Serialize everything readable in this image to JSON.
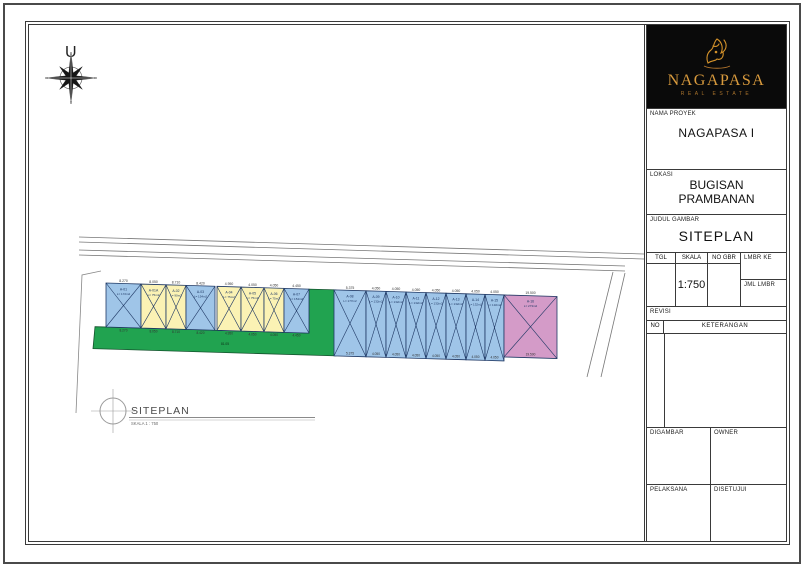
{
  "sheet": {
    "north_label": "U"
  },
  "plan": {
    "title": "SITEPLAN",
    "scale_note": "SKALA 1 : 750",
    "green_dim": "81.05",
    "colors": {
      "blue": "#9fc5e8",
      "yellow": "#fbf2b4",
      "green": "#21a350",
      "pink": "#d49bc8",
      "stroke": "#1f3864",
      "road": "#777777"
    },
    "lots": [
      {
        "id": "A-01",
        "area": "L= 172m2",
        "dim": "8.270",
        "color": "blue",
        "x": 77,
        "w": 35,
        "group": "front"
      },
      {
        "id": "A-01A",
        "area": "L= 75m2",
        "dim": "8.050",
        "color": "yellow",
        "x": 112,
        "w": 25,
        "group": "front"
      },
      {
        "id": "A-02",
        "area": "L= 90m2",
        "dim": "8.710",
        "color": "yellow",
        "x": 137,
        "w": 20,
        "group": "front"
      },
      {
        "id": "A-03",
        "area": "L= 154m2",
        "dim": "8.420",
        "color": "blue",
        "x": 157,
        "w": 29,
        "group": "front"
      },
      {
        "id": "A-04",
        "area": "L= 75m2",
        "dim": "4.950",
        "color": "yellow",
        "x": 188,
        "w": 24,
        "group": "front"
      },
      {
        "id": "A-05",
        "area": "L= 75m2",
        "dim": "4.050",
        "color": "yellow",
        "x": 212,
        "w": 23,
        "group": "front"
      },
      {
        "id": "A-06",
        "area": "L= 75m2",
        "dim": "4.050",
        "color": "yellow",
        "x": 235,
        "w": 20,
        "group": "front"
      },
      {
        "id": "A-07",
        "area": "L= 154m2",
        "dim": "4.450",
        "color": "blue",
        "x": 255,
        "w": 25,
        "group": "front"
      },
      {
        "id": "A-08",
        "area": "L= 177m2",
        "dim": "5.375",
        "color": "blue",
        "x": 305,
        "w": 32,
        "group": "back"
      },
      {
        "id": "A-09",
        "area": "L= 132m2",
        "dim": "4.050",
        "color": "blue",
        "x": 337,
        "w": 20,
        "group": "back"
      },
      {
        "id": "A-10",
        "area": "L= 132m2",
        "dim": "4.050",
        "color": "blue",
        "x": 357,
        "w": 20,
        "group": "back"
      },
      {
        "id": "A-11",
        "area": "L= 132m2",
        "dim": "4.050",
        "color": "blue",
        "x": 377,
        "w": 20,
        "group": "back"
      },
      {
        "id": "A-12",
        "area": "L= 132m2",
        "dim": "4.050",
        "color": "blue",
        "x": 397,
        "w": 20,
        "group": "back"
      },
      {
        "id": "A-13",
        "area": "L= 132m2",
        "dim": "4.050",
        "color": "blue",
        "x": 417,
        "w": 20,
        "group": "back"
      },
      {
        "id": "A-14",
        "area": "L= 132m2",
        "dim": "4.050",
        "color": "blue",
        "x": 437,
        "w": 19,
        "group": "back"
      },
      {
        "id": "A-15",
        "area": "L= 132m2",
        "dim": "4.050",
        "color": "blue",
        "x": 456,
        "w": 19,
        "group": "back"
      },
      {
        "id": "A-16",
        "area": "L= 273m2",
        "dim": "19.500",
        "color": "pink",
        "x": 475,
        "w": 53,
        "group": "big"
      }
    ]
  },
  "titleblock": {
    "logo": {
      "brand": "NAGAPASA",
      "tagline": "REAL ESTATE"
    },
    "nama_proyek_label": "NAMA PROYEK",
    "nama_proyek": "NAGAPASA I",
    "lokasi_label": "LOKASI",
    "lokasi_line1": "BUGISAN",
    "lokasi_line2": "PRAMBANAN",
    "judul_label": "JUDUL GAMBAR",
    "judul": "SITEPLAN",
    "tgl_label": "TGL",
    "skala_label": "SKALA",
    "skala_value": "1:750",
    "no_gbr_label": "NO GBR",
    "lmbr_ke_label": "LMBR KE",
    "jml_lmbr_label": "JML LMBR",
    "revisi_label": "REVISI",
    "no_label": "NO",
    "keterangan_label": "KETERANGAN",
    "digambar_label": "DIGAMBAR",
    "owner_label": "OWNER",
    "pelaksana_label": "PELAKSANA",
    "disetujui_label": "DISETUJUI"
  }
}
